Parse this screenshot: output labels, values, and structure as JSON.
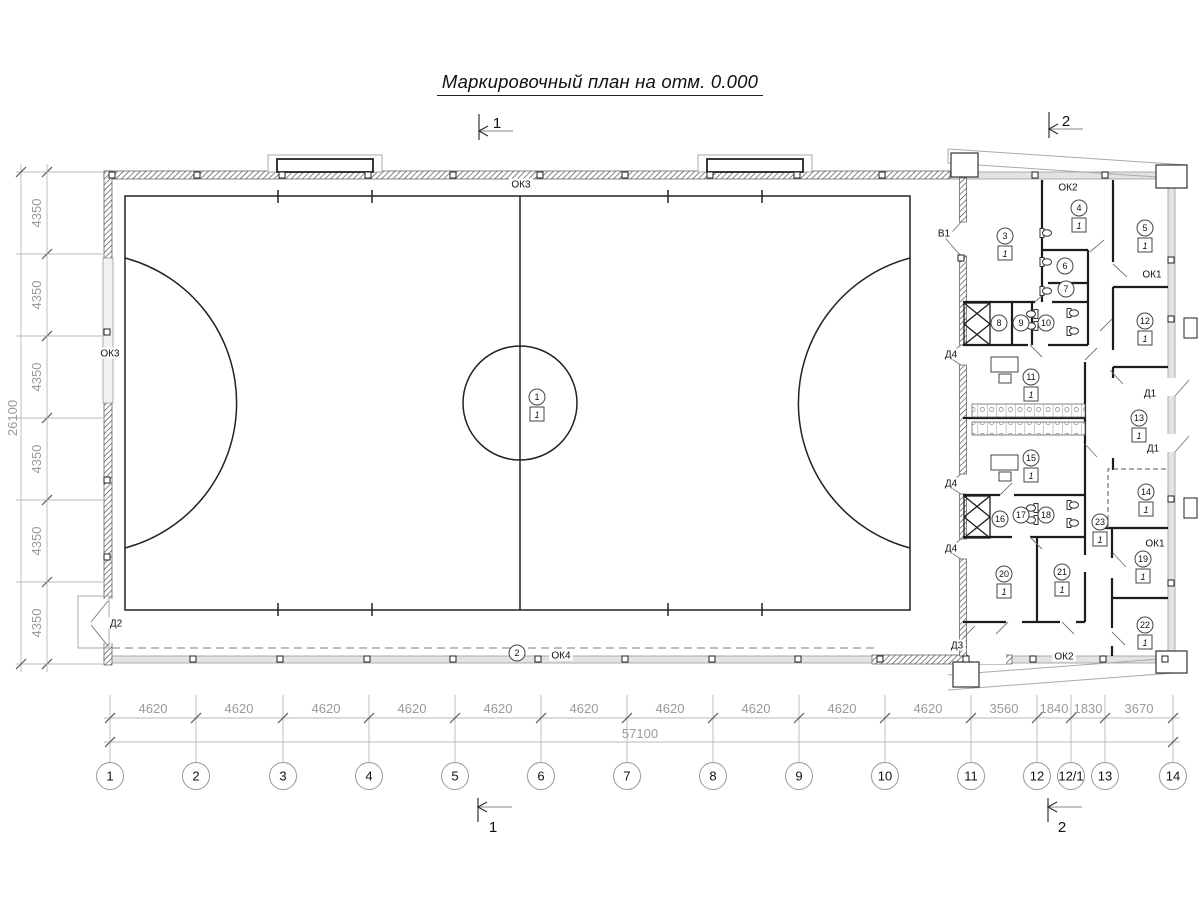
{
  "title": "Маркировочный план на отм. 0.000",
  "sections": {
    "top_left": "1",
    "top_right": "2",
    "bottom_left": "1",
    "bottom_right": "2"
  },
  "grid_axis": {
    "bubbles": [
      {
        "label": "1",
        "x": 110
      },
      {
        "label": "2",
        "x": 196
      },
      {
        "label": "3",
        "x": 283
      },
      {
        "label": "4",
        "x": 369
      },
      {
        "label": "5",
        "x": 455
      },
      {
        "label": "6",
        "x": 541
      },
      {
        "label": "7",
        "x": 627
      },
      {
        "label": "8",
        "x": 713
      },
      {
        "label": "9",
        "x": 799
      },
      {
        "label": "10",
        "x": 885
      },
      {
        "label": "11",
        "x": 971
      },
      {
        "label": "12",
        "x": 1037
      },
      {
        "label": "12/1",
        "x": 1071
      },
      {
        "label": "13",
        "x": 1105
      },
      {
        "label": "14",
        "x": 1173
      }
    ],
    "spans": [
      {
        "value": "4620",
        "x": 153
      },
      {
        "value": "4620",
        "x": 239
      },
      {
        "value": "4620",
        "x": 326
      },
      {
        "value": "4620",
        "x": 412
      },
      {
        "value": "4620",
        "x": 498
      },
      {
        "value": "4620",
        "x": 584
      },
      {
        "value": "4620",
        "x": 670
      },
      {
        "value": "4620",
        "x": 756
      },
      {
        "value": "4620",
        "x": 842
      },
      {
        "value": "4620",
        "x": 928
      },
      {
        "value": "3560",
        "x": 1004
      },
      {
        "value": "1840",
        "x": 1054
      },
      {
        "value": "1830",
        "x": 1088
      },
      {
        "value": "3670",
        "x": 1139
      }
    ],
    "total": {
      "value": "57100",
      "x": 640
    }
  },
  "left_axis": {
    "segments": [
      {
        "value": "4350",
        "y": 213
      },
      {
        "value": "4350",
        "y": 295
      },
      {
        "value": "4350",
        "y": 377
      },
      {
        "value": "4350",
        "y": 459
      },
      {
        "value": "4350",
        "y": 541
      },
      {
        "value": "4350",
        "y": 623
      }
    ],
    "total": {
      "value": "26100",
      "y": 418
    }
  },
  "rooms": [
    {
      "num": "1",
      "x": 537,
      "y": 397,
      "floor": "1"
    },
    {
      "num": "2",
      "x": 517,
      "y": 653
    },
    {
      "num": "3",
      "x": 1005,
      "y": 236,
      "floor": "1"
    },
    {
      "num": "4",
      "x": 1079,
      "y": 208,
      "floor": "1"
    },
    {
      "num": "5",
      "x": 1145,
      "y": 228,
      "floor": "1"
    },
    {
      "num": "6",
      "x": 1065,
      "y": 266
    },
    {
      "num": "7",
      "x": 1066,
      "y": 289
    },
    {
      "num": "8",
      "x": 999,
      "y": 323
    },
    {
      "num": "9",
      "x": 1021,
      "y": 323
    },
    {
      "num": "10",
      "x": 1046,
      "y": 323
    },
    {
      "num": "11",
      "x": 1031,
      "y": 377,
      "floor": "1"
    },
    {
      "num": "12",
      "x": 1145,
      "y": 321,
      "floor": "1"
    },
    {
      "num": "13",
      "x": 1139,
      "y": 418,
      "floor": "1"
    },
    {
      "num": "14",
      "x": 1146,
      "y": 492,
      "floor": "1"
    },
    {
      "num": "15",
      "x": 1031,
      "y": 458,
      "floor": "1"
    },
    {
      "num": "16",
      "x": 1000,
      "y": 519
    },
    {
      "num": "17",
      "x": 1021,
      "y": 515
    },
    {
      "num": "18",
      "x": 1046,
      "y": 515
    },
    {
      "num": "19",
      "x": 1143,
      "y": 559,
      "floor": "1"
    },
    {
      "num": "20",
      "x": 1004,
      "y": 574,
      "floor": "1"
    },
    {
      "num": "21",
      "x": 1062,
      "y": 572,
      "floor": "1"
    },
    {
      "num": "22",
      "x": 1145,
      "y": 625,
      "floor": "1"
    },
    {
      "num": "23",
      "x": 1100,
      "y": 522,
      "floor": "1"
    }
  ],
  "openings": [
    {
      "label": "ОК3",
      "x": 521,
      "y": 184
    },
    {
      "label": "ОК3",
      "x": 110,
      "y": 353
    },
    {
      "label": "ОК2",
      "x": 1068,
      "y": 187
    },
    {
      "label": "ОК2",
      "x": 1064,
      "y": 656
    },
    {
      "label": "ОК1",
      "x": 1152,
      "y": 274
    },
    {
      "label": "ОК1",
      "x": 1155,
      "y": 543
    },
    {
      "label": "ОК4",
      "x": 561,
      "y": 655
    },
    {
      "label": "В1",
      "x": 944,
      "y": 233
    },
    {
      "label": "Д1",
      "x": 1150,
      "y": 393
    },
    {
      "label": "Д1",
      "x": 1153,
      "y": 448
    },
    {
      "label": "Д2",
      "x": 116,
      "y": 623
    },
    {
      "label": "Д3",
      "x": 957,
      "y": 645
    },
    {
      "label": "Д4",
      "x": 951,
      "y": 354
    },
    {
      "label": "Д4",
      "x": 951,
      "y": 483
    },
    {
      "label": "Д4",
      "x": 951,
      "y": 548
    }
  ],
  "colors": {
    "line": "#1c1c1c",
    "wall_fill": "#e3e3e3",
    "dim": "#9a9a9a"
  }
}
